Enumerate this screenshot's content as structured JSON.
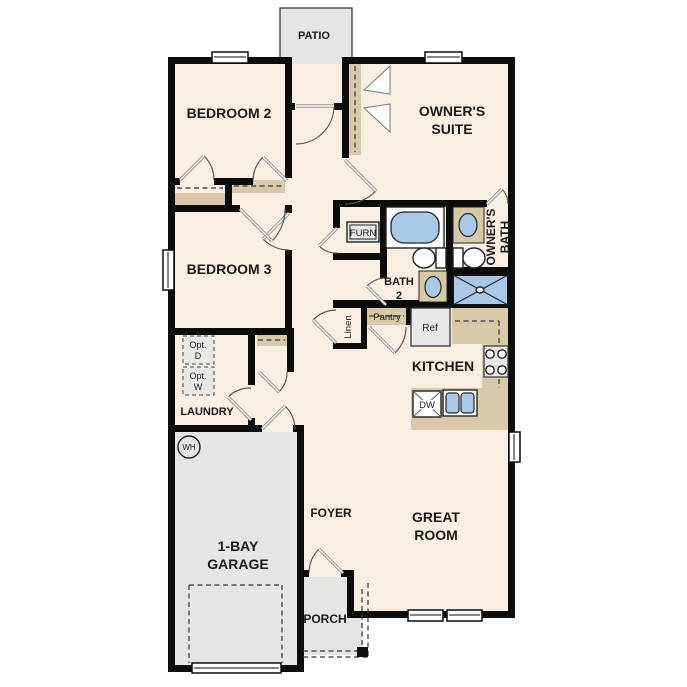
{
  "colors": {
    "wall": "#0c0c0c",
    "floor": "#f8efe2",
    "outdoor": "#e5e5e3",
    "counter": "#d8c9a9",
    "blue": "#a9c9e8",
    "appliance": "#e8e8e6",
    "text": "#1a1a1a"
  },
  "labels": {
    "patio": "PATIO",
    "bedroom2": "BEDROOM 2",
    "owners_suite": [
      "OWNER'S",
      "SUITE"
    ],
    "bedroom3": "BEDROOM 3",
    "owners_bath": [
      "OWNER'S",
      "BATH"
    ],
    "bath2": [
      "BATH",
      "2"
    ],
    "furnace": "FURN",
    "linen": "Linen",
    "pantry": "Pantry",
    "refrigerator": "Ref",
    "kitchen": "KITCHEN",
    "dishwasher": "DW",
    "opt_dryer": [
      "Opt.",
      "D"
    ],
    "opt_washer": [
      "Opt.",
      "W"
    ],
    "laundry": "LAUNDRY",
    "water_heater": "WH",
    "garage": [
      "1-BAY",
      "GARAGE"
    ],
    "foyer": "FOYER",
    "great_room": [
      "GREAT",
      "ROOM"
    ],
    "porch": "PORCH"
  }
}
